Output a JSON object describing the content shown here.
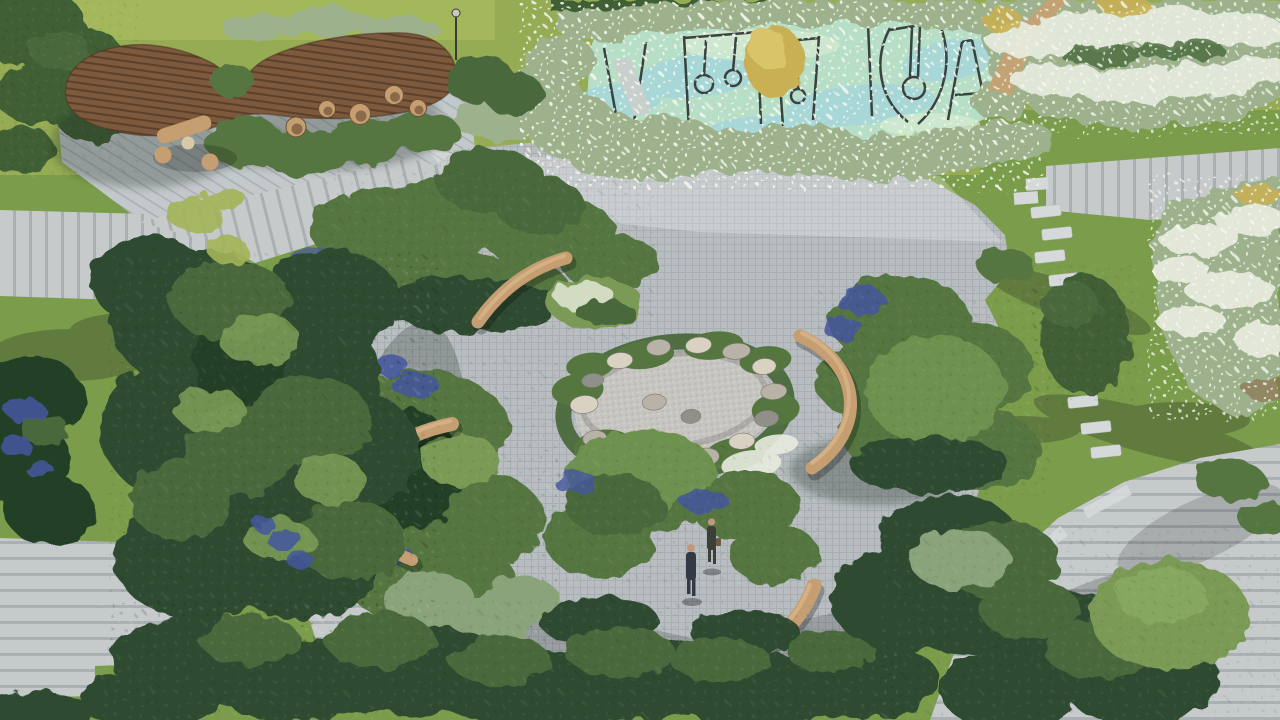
{
  "scene": {
    "type": "aerial-architectural-rendering",
    "description": "Bird's-eye rendering of a courtyard landscape: curved timber canopy lounge with hanging chairs, mint-surfaced children's playground, central looping garden with dry gravel pond ringed by boulders, curved timber benches, plank stone walkways, lawns, white perennial beds and two people walking",
    "people_visible": 2
  },
  "labels": {
    "pergola": "Curved timber canopy",
    "hanging_chairs": "Hanging egg chairs",
    "lounge_set": "Wicker lounge set",
    "playground": "Playground with swings and slide",
    "gold_shrub": "Golden shrub",
    "central_garden": "Central sensory garden",
    "pond": "Dry gravel pond with boulders",
    "bench": "Curved timber bench",
    "plank_path": "Stone plank walkway",
    "stepping_path": "Stepping stone path",
    "white_bed": "White perennial bed",
    "blue_flowers": "Blue perennials",
    "lawn": "Lawn",
    "trees": "Tree and shrub massing",
    "people": "Two visitors walking",
    "lamp": "Garden light pole"
  },
  "colors": {
    "lawn_light": "#95ac54",
    "lawn_bright": "#a9bd5e",
    "lawn_mid": "#7b9c4a",
    "lawn_dark": "#5e7f3e",
    "paving_light": "#ccd0d2",
    "paving_mid": "#b7bdc0",
    "paving_shadow": "#8f989d",
    "plank": "#c6cacb",
    "step_stone": "#d6d9da",
    "wood": "#7d5a3d",
    "wood_dark": "#5c402a",
    "bench": "#c59e72",
    "bench_shadow": "#8a6a48",
    "pond_gravel": "#c7c5c0",
    "rock_light": "#d9d2c2",
    "rock_mid": "#b8b3a6",
    "rock_dark": "#90908a",
    "playground": "#b7dfc7",
    "playground_blue": "#9fd4e0",
    "playground_lightgreen": "#d2ead0",
    "hedge_dark": "#3f5e36",
    "tree_dark": "#2f4c30",
    "tree_deep": "#243f28",
    "tree_mid": "#49693c",
    "tree_light": "#6d9150",
    "shrub_green": "#55763f",
    "shrub_light": "#7a9a55",
    "sage": "#9db18c",
    "sage_dark": "#8aa37a",
    "white_flower": "#e8ecdf",
    "blue_flower": "#44569e",
    "gold_shrub": "#c9b054",
    "gold_light": "#dcc96e",
    "sun_bush": "#a4b457",
    "dirt": "#c3a274",
    "equipment": "#39423e",
    "slide_metal": "#c9cfcd",
    "person_suit": "#343a45",
    "person_suit2": "#3d4038",
    "person_skin": "#c19a7e",
    "shadow": "#1f2a20"
  }
}
